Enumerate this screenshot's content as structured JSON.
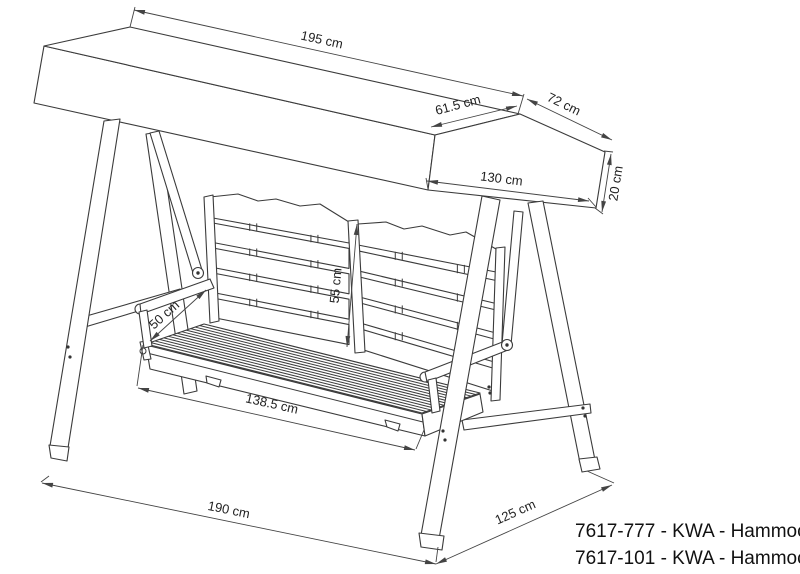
{
  "drawing": {
    "type": "technical-line-drawing",
    "subject": "hammock swing with canopy - dimensioned drawing",
    "colors": {
      "line": "#3b3b3b",
      "dimension_text": "#222222",
      "product_text": "#111111",
      "background": "#ffffff"
    },
    "dimensions": [
      {
        "id": "canopy-length",
        "label": "195 cm",
        "x1": 134,
        "y1": 10,
        "x2": 523,
        "y2": 96,
        "lx": 321,
        "ly": 44,
        "rot": 12.5
      },
      {
        "id": "canopy-front-slope",
        "label": "61.5 cm",
        "x1": 431,
        "y1": 127,
        "x2": 517,
        "y2": 106,
        "lx": 459,
        "ly": 109,
        "rot": -15
      },
      {
        "id": "canopy-back-slope",
        "label": "72 cm",
        "x1": 527,
        "y1": 99,
        "x2": 612,
        "y2": 140,
        "lx": 562,
        "ly": 108,
        "rot": 26
      },
      {
        "id": "canopy-depth",
        "label": "130 cm",
        "x1": 427,
        "y1": 181,
        "x2": 589,
        "y2": 201,
        "lx": 501,
        "ly": 183,
        "rot": 7
      },
      {
        "id": "canopy-skirt-height",
        "label": "20 cm",
        "x1": 611,
        "y1": 154,
        "x2": 602,
        "y2": 212,
        "lx": 620,
        "ly": 184,
        "rot": -81
      },
      {
        "id": "backrest-height",
        "label": "55 cm",
        "x1": 357,
        "y1": 224,
        "x2": 347,
        "y2": 347,
        "lx": 340,
        "ly": 286,
        "rot": -85
      },
      {
        "id": "seat-depth",
        "label": "50 cm",
        "x1": 150,
        "y1": 341,
        "x2": 206,
        "y2": 290,
        "lx": 167,
        "ly": 318,
        "rot": -42
      },
      {
        "id": "seat-width",
        "label": "138.5 cm",
        "x1": 138,
        "y1": 388,
        "x2": 415,
        "y2": 450,
        "lx": 271,
        "ly": 408,
        "rot": 12.6
      },
      {
        "id": "frame-width",
        "label": "190 cm",
        "x1": 42,
        "y1": 483,
        "x2": 436,
        "y2": 564,
        "lx": 228,
        "ly": 514,
        "rot": 11.6
      },
      {
        "id": "frame-depth",
        "label": "125 cm",
        "x1": 436,
        "y1": 564,
        "x2": 612,
        "y2": 485,
        "lx": 517,
        "ly": 516,
        "rot": -24
      }
    ],
    "extension_lines": [
      [
        130,
        27,
        135,
        7
      ],
      [
        518,
        114,
        524,
        94
      ],
      [
        428,
        189,
        426,
        178
      ],
      [
        596,
        207,
        588,
        198
      ],
      [
        604,
        151,
        613,
        152
      ],
      [
        595,
        208,
        603,
        214
      ],
      [
        143,
        345,
        137,
        386
      ],
      [
        424,
        430,
        416,
        449
      ],
      [
        49,
        476,
        41,
        482
      ],
      [
        438,
        547,
        436,
        562
      ],
      [
        587,
        471,
        614,
        483
      ]
    ],
    "products": [
      "7617-777 - KWA - Hammock",
      "7617-101 - KWA - Hammock"
    ]
  }
}
